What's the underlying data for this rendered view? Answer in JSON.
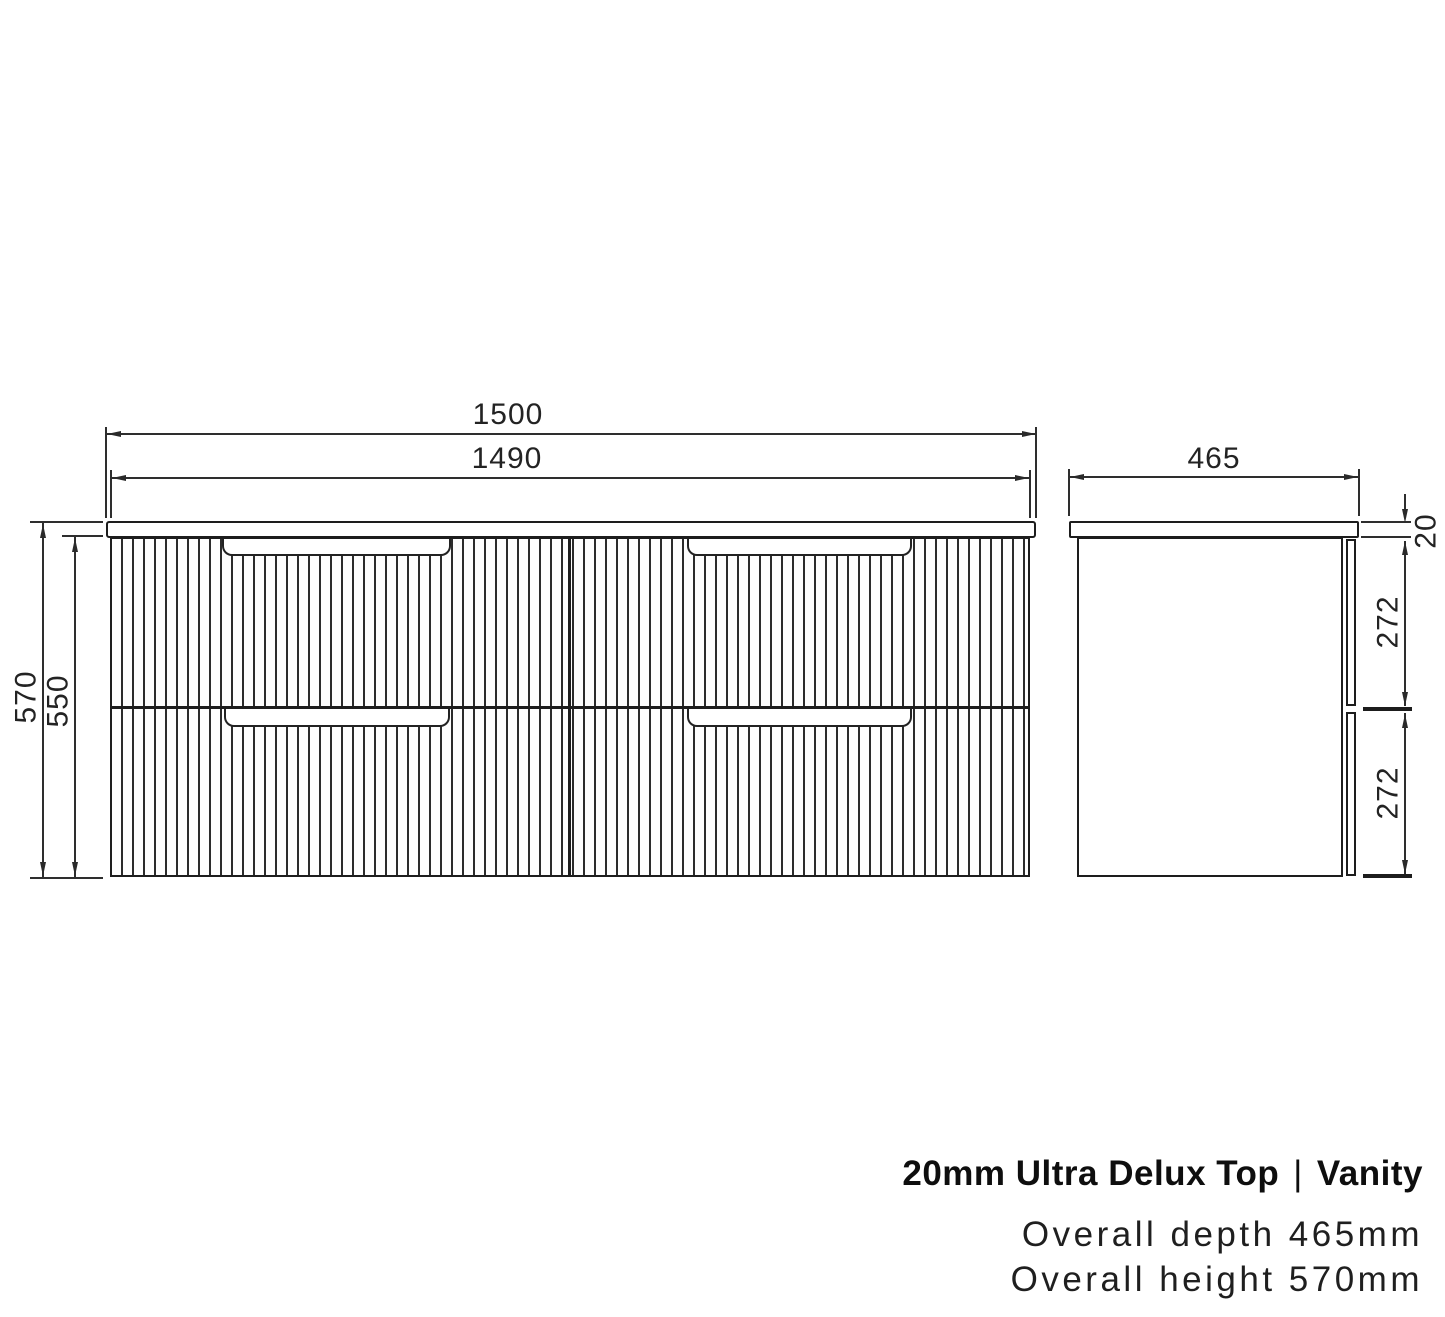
{
  "drawing": {
    "front_view": {
      "dim_width_overall": "1500",
      "dim_width_cabinet": "1490",
      "dim_height_overall": "570",
      "dim_height_cabinet": "550"
    },
    "side_view": {
      "dim_depth": "465",
      "dim_top_thickness": "20",
      "dim_drawer_upper": "272",
      "dim_drawer_lower": "272"
    }
  },
  "caption": {
    "product": "20mm Ultra Delux Top",
    "separator": "|",
    "category": "Vanity",
    "spec_depth": "Overall depth 465mm",
    "spec_height": "Overall height 570mm"
  },
  "colors": {
    "line": "#1d1d1d",
    "background": "#ffffff",
    "text": "#0e0e0e"
  }
}
